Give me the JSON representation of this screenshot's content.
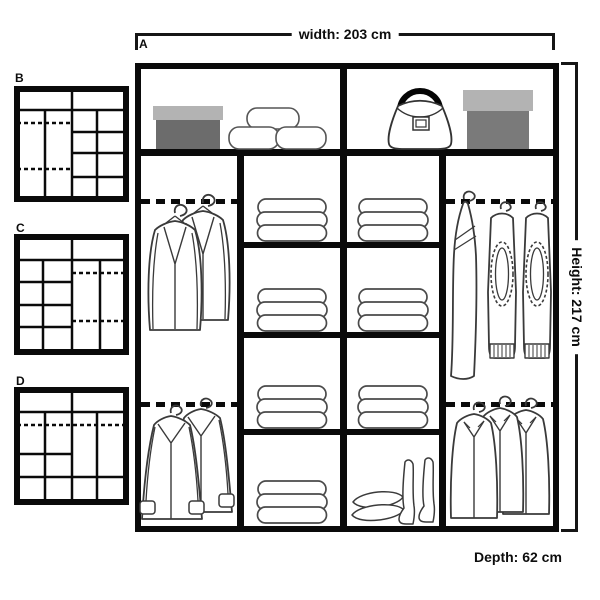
{
  "diagram": {
    "type": "wardrobe-interior-layout",
    "width_label": "width: 203 cm",
    "height_label": "Height: 217 cm",
    "depth_label": "Depth: 62 cm"
  },
  "variants": {
    "a": {
      "label": "A"
    },
    "b": {
      "label": "B"
    },
    "c": {
      "label": "C"
    },
    "d": {
      "label": "D"
    }
  },
  "colors": {
    "frame": "#0a0a0a",
    "box_lid": "#b3b3b3",
    "box_body_left": "#6c6c6c",
    "box_body_right": "#7a7a7a"
  },
  "wardrobe_a": {
    "top_shelf": {
      "left_compartment": [
        "shoebox",
        "soft-storage-cushions"
      ],
      "right_compartment": [
        "handbag",
        "storage-box"
      ]
    },
    "columns": [
      {
        "name": "left-hanging-column",
        "rails": 2,
        "contents": [
          "two-jackets-on-hangers",
          "two-coats-on-hangers"
        ]
      },
      {
        "name": "inner-shelf-column-left",
        "shelves": 4,
        "contents": [
          "folded-clothes",
          "folded-clothes",
          "folded-clothes",
          "folded-clothes"
        ]
      },
      {
        "name": "inner-shelf-column-right",
        "shelves": 4,
        "contents": [
          "folded-clothes",
          "folded-clothes",
          "folded-clothes",
          "cushions-and-boots"
        ]
      },
      {
        "name": "right-hanging-column",
        "rails": 2,
        "contents": [
          "dress-and-two-jeans-on-hangers",
          "three-shirts-on-hangers"
        ]
      }
    ]
  }
}
